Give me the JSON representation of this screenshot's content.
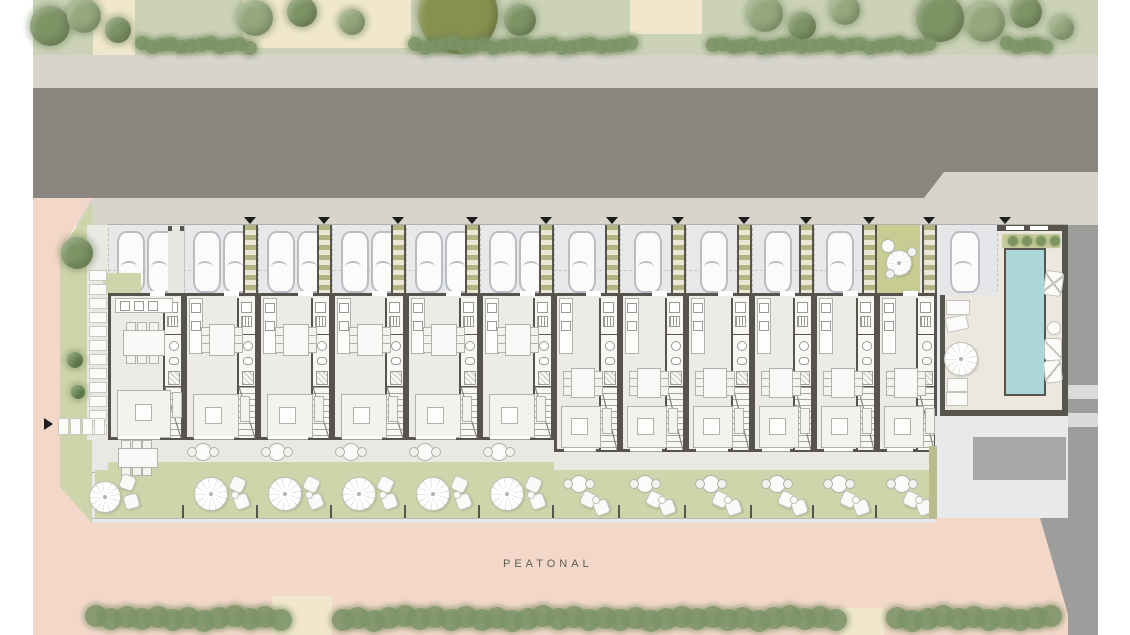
{
  "plan": {
    "title": "residential-row-site-plan",
    "pedestrian_label": "PEATONAL",
    "colors": {
      "grass_top": "#ccd2b8",
      "beige": "#f0e7cd",
      "sidewalk": "#d7d4cc",
      "road": "#8b8680",
      "street": "#9d9d9b",
      "street_band": "#dadad8",
      "pink": "#f3d8ca",
      "plot_bg": "#e7e8ea",
      "parking_bg": "#e4e6e9",
      "car_fill": "#fbfbfa",
      "car_border": "#b9bdc2",
      "walkway_stripe": "#b1b483",
      "walkway_bg": "#ece7d5",
      "wall": "#57544e",
      "floor": "#ecebe7",
      "core": "#f8f7f4",
      "furn": "#f3f2ef",
      "furn_border": "#b2b2ad",
      "terrace": "#e9e8e3",
      "lawn": "#cfd5aa",
      "lawn_bright": "#c6cc92",
      "pool": "#abd7d9",
      "courtyard_floor": "#ece7df",
      "pad": "#a8a8a6",
      "hedge": "#7d9468",
      "marker": "#1c1c1c",
      "tree_tones": [
        "#94a87c",
        "#7e9465",
        "#6d8a52",
        "#87914f"
      ]
    },
    "units": [
      {
        "kind": "wide",
        "x": 108,
        "w": 76,
        "cars": 2,
        "first": true
      },
      {
        "kind": "wide",
        "x": 184,
        "w": 74,
        "cars": 2
      },
      {
        "kind": "wide",
        "x": 258,
        "w": 74,
        "cars": 2
      },
      {
        "kind": "wide",
        "x": 332,
        "w": 74,
        "cars": 2
      },
      {
        "kind": "wide",
        "x": 406,
        "w": 74,
        "cars": 2
      },
      {
        "kind": "wide",
        "x": 480,
        "w": 74,
        "cars": 2
      },
      {
        "kind": "narrow",
        "x": 554,
        "w": 66,
        "cars": 1
      },
      {
        "kind": "narrow",
        "x": 620,
        "w": 66,
        "cars": 1
      },
      {
        "kind": "narrow",
        "x": 686,
        "w": 66,
        "cars": 1
      },
      {
        "kind": "narrow",
        "x": 752,
        "w": 62,
        "cars": 1
      },
      {
        "kind": "narrow",
        "x": 814,
        "w": 63,
        "cars": 1
      },
      {
        "kind": "narrow",
        "x": 877,
        "w": 60,
        "cars": 0,
        "courtyard": true
      }
    ],
    "scenery": {
      "trees_top": [
        [
          50,
          26,
          20,
          1
        ],
        [
          84,
          16,
          17,
          0
        ],
        [
          118,
          30,
          13,
          1
        ],
        [
          255,
          18,
          18,
          0
        ],
        [
          302,
          12,
          15,
          1
        ],
        [
          352,
          22,
          13,
          0
        ],
        [
          458,
          14,
          40,
          3
        ],
        [
          520,
          20,
          16,
          1
        ],
        [
          765,
          14,
          18,
          0
        ],
        [
          802,
          26,
          14,
          1
        ],
        [
          845,
          10,
          15,
          0
        ],
        [
          940,
          18,
          24,
          1
        ],
        [
          985,
          22,
          20,
          0
        ],
        [
          1026,
          12,
          16,
          1
        ],
        [
          1062,
          28,
          12,
          0
        ],
        [
          77,
          253,
          16,
          1
        ],
        [
          75,
          360,
          8,
          2
        ],
        [
          78,
          392,
          7,
          2
        ]
      ],
      "hedge_top_segments": [
        [
          135,
          245
        ],
        [
          408,
          628
        ],
        [
          706,
          930
        ],
        [
          1000,
          1046
        ]
      ],
      "hedge_bottom_segments": [
        [
          85,
          272
        ],
        [
          332,
          838
        ],
        [
          886,
          1046
        ]
      ],
      "beige_patches": [
        [
          93,
          0,
          42,
          55
        ],
        [
          243,
          0,
          168,
          48
        ],
        [
          630,
          0,
          72,
          34
        ],
        [
          272,
          596,
          60,
          39
        ],
        [
          840,
          608,
          44,
          27
        ]
      ],
      "pool_bushes_x": [
        1008,
        1022,
        1036,
        1050
      ],
      "street_bands_y": [
        385,
        413
      ],
      "triangle_extra_x": [
        1005
      ]
    }
  }
}
